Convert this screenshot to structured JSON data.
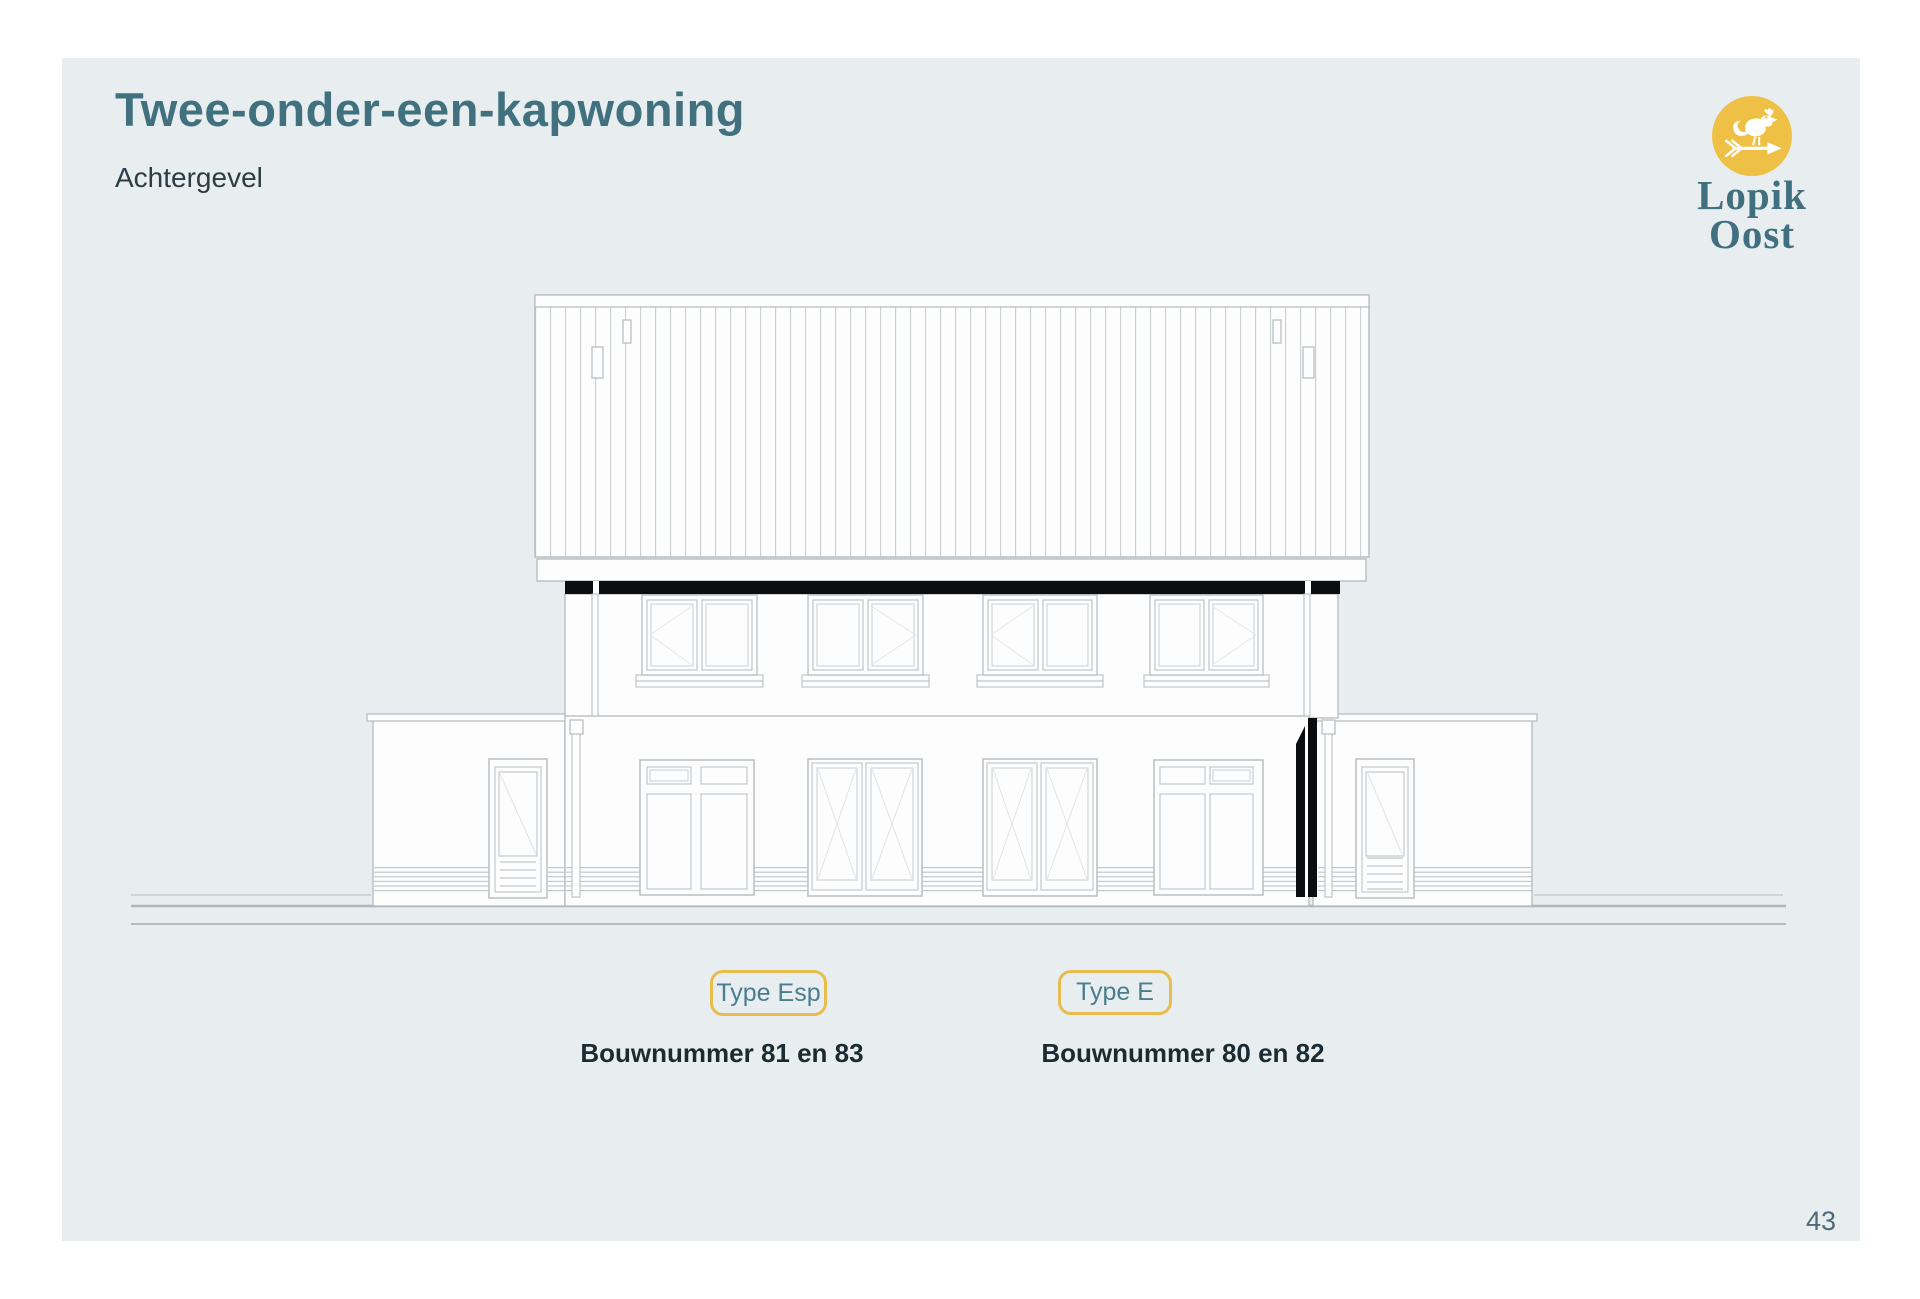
{
  "page": {
    "number": "43",
    "background": "#ffffff",
    "card_background": "#e8eeef"
  },
  "header": {
    "title": "Twee-onder-een-kapwoning",
    "subtitle": "Achtergevel"
  },
  "logo": {
    "line1": "Lopik",
    "line2": "Oost",
    "icon": "rooster-weathervane-icon",
    "circle_color": "#eec045",
    "text_color": "#40707f"
  },
  "drawing": {
    "title": "Achtergevel"
  },
  "badges": [
    {
      "label": "Type Esp",
      "caption": "Bouwnummer 81 en 83"
    },
    {
      "label": "Type E",
      "caption": "Bouwnummer 80 en 82"
    }
  ],
  "colors": {
    "accent_teal": "#41717f",
    "accent_yellow": "#e9bd4d",
    "text_dark": "#1b2b33",
    "drawing_line": "#b4bbbf",
    "drawing_black": "#0b0d0e"
  }
}
